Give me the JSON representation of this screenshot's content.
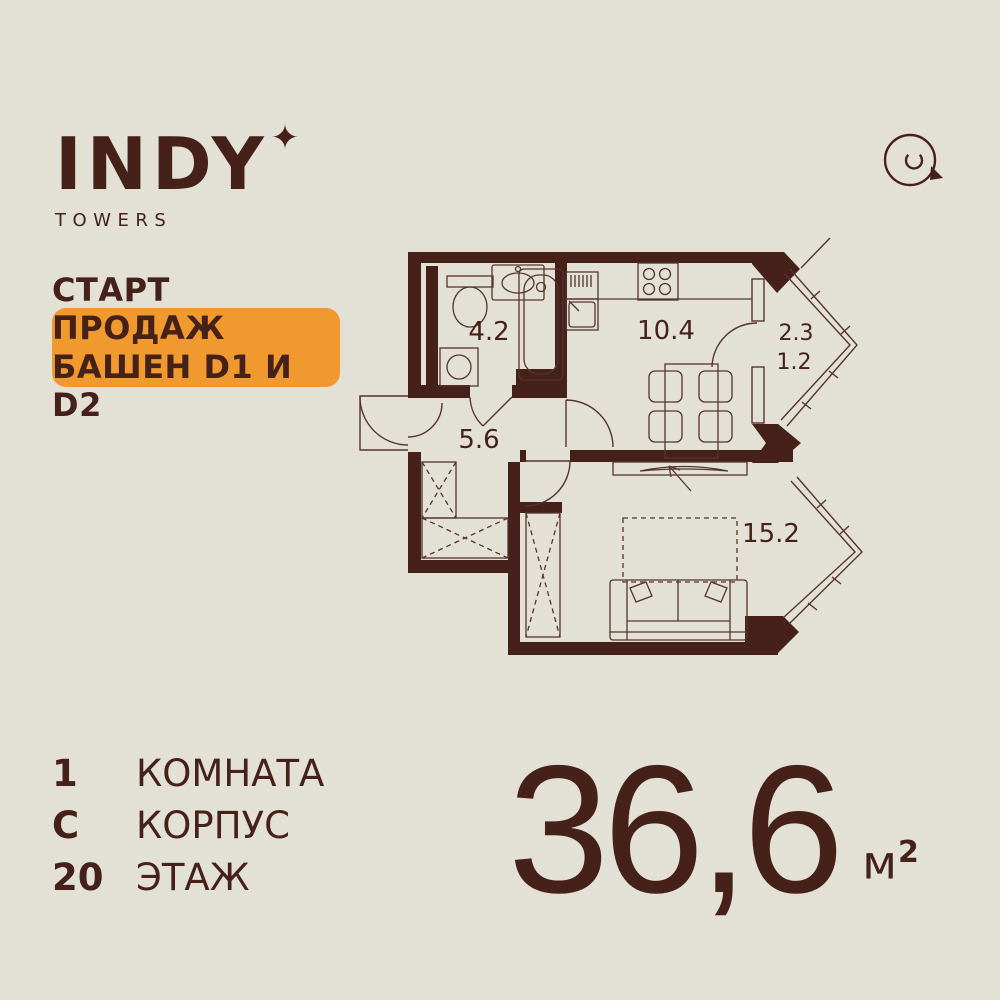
{
  "brand": {
    "name": "INDY",
    "star": "✦",
    "subtitle": "TOWERS"
  },
  "badge": {
    "line1": "СТАРТ ПРОДАЖ",
    "line2": "БАШЕН D1 И D2"
  },
  "floorplan": {
    "labels": {
      "bathroom": "4.2",
      "hall": "5.6",
      "kitchen": "10.4",
      "living": "15.2",
      "balcony_full": "2.3",
      "balcony_reduced": "1.2"
    }
  },
  "specs": {
    "rows": [
      {
        "value": "1",
        "label": "КОМНАТА"
      },
      {
        "value": "С",
        "label": "КОРПУС"
      },
      {
        "value": "20",
        "label": "ЭТАЖ"
      }
    ]
  },
  "area": {
    "value": "36,6",
    "unit": "м",
    "unit_sup": "2"
  },
  "colors": {
    "background": "#e3e1d5",
    "ink": "#45211a",
    "accent": "#f0992e"
  }
}
